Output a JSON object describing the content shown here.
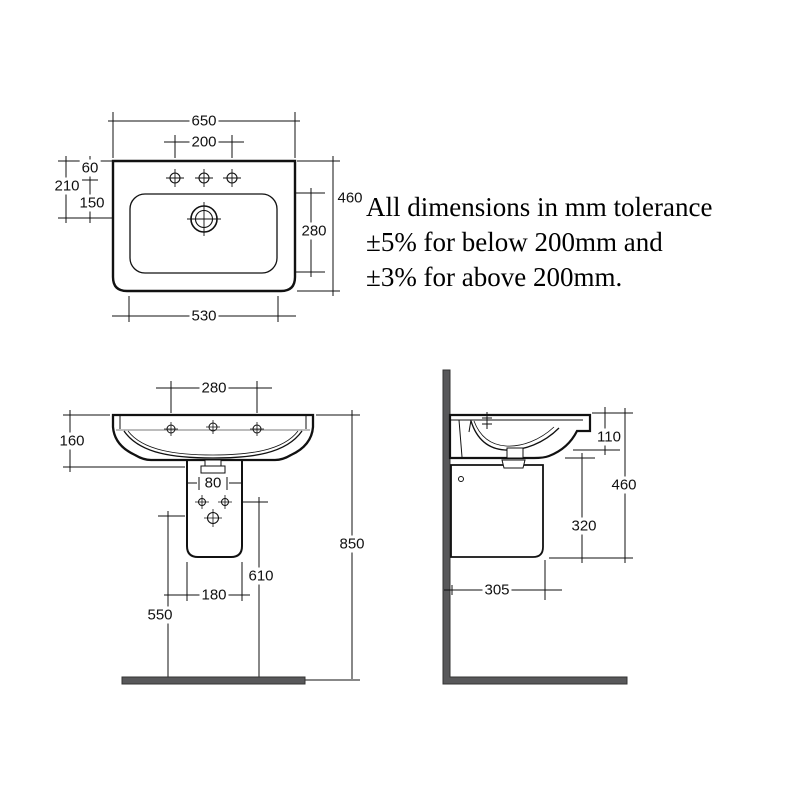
{
  "note": {
    "line1": "All dimensions in mm tolerance",
    "line2": "±5% for below 200mm and",
    "line3": "±3% for above 200mm."
  },
  "colors": {
    "line": "#111111",
    "wall_fill": "#58585a",
    "wall_edge": "#333333",
    "background": "#ffffff"
  },
  "views": {
    "top": {
      "name": "Top view",
      "dims": {
        "overall_width": "650",
        "tap_hole_spacing": "200",
        "front_edge_to_tap_holes": "60",
        "front_edge_to_drain": "210",
        "tap_holes_to_drain": "150",
        "overall_depth": "460",
        "bowl_depth": "280",
        "bowl_width": "530"
      }
    },
    "front": {
      "name": "Front view",
      "dims": {
        "outer_tap_hole_spacing": "280",
        "basin_height": "160",
        "fixing_hole_spacing": "80",
        "pedestal_width": "180",
        "floor_to_fixing_holes": "610",
        "floor_to_lower_fixing": "550",
        "overall_height": "850"
      }
    },
    "side": {
      "name": "Side view",
      "dims": {
        "front_edge_height": "110",
        "basin_top_to_pedestal_bottom": "460",
        "pedestal_height": "320",
        "projection": "305"
      }
    }
  }
}
